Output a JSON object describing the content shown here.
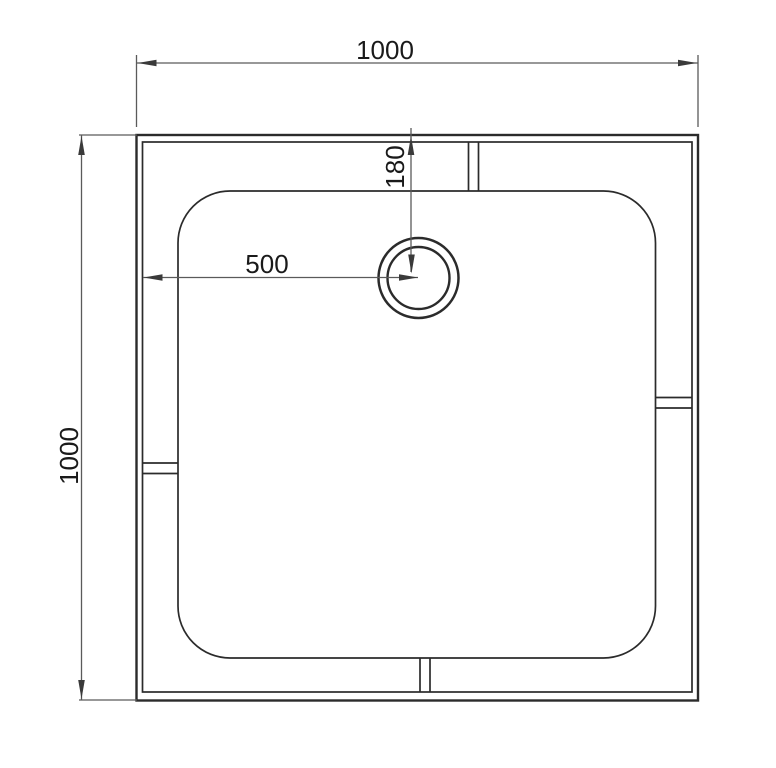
{
  "page": {
    "background_color": "#ffffff"
  },
  "drawing": {
    "colors": {
      "outline": "#2b2b2b",
      "dimension_line": "#5a5a5a",
      "arrow": "#3a3a3a",
      "label_text": "#1a1a1a"
    },
    "dimension_labels": {
      "overall_width": "1000",
      "overall_depth": "1000",
      "drain_offset_from_left": "500",
      "drain_offset_from_top": "180"
    }
  }
}
